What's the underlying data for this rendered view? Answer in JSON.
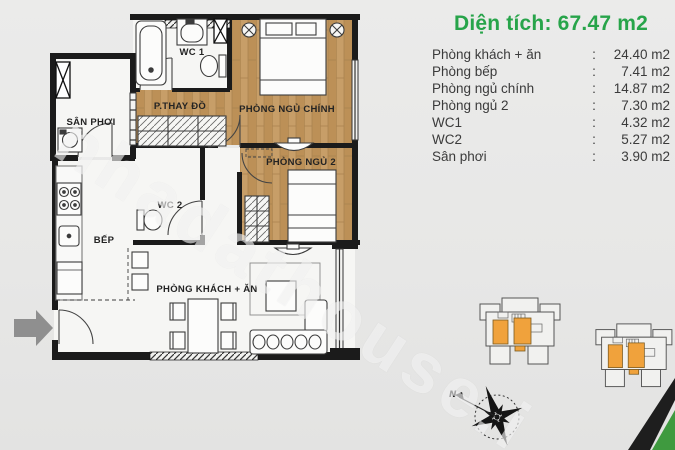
{
  "info": {
    "title": "Diện tích: 67.47 m2",
    "rows": [
      {
        "label": "Phòng khách + ăn",
        "sep": ":",
        "value": "24.40 m2"
      },
      {
        "label": "Phòng bếp",
        "sep": ":",
        "value": "7.41 m2"
      },
      {
        "label": "Phòng ngủ chính",
        "sep": ":",
        "value": "14.87 m2"
      },
      {
        "label": "Phòng ngủ 2",
        "sep": ":",
        "value": "7.30 m2"
      },
      {
        "label": "WC1",
        "sep": ":",
        "value": "4.32 m2"
      },
      {
        "label": "WC2",
        "sep": ":",
        "value": "5.27 m2"
      },
      {
        "label": "Sân phơi",
        "sep": ":",
        "value": "3.90 m2"
      }
    ]
  },
  "floorplan": {
    "labels": {
      "wc1": "WC 1",
      "dressing": "P.THAY ĐỒ",
      "master_bedroom": "PHÒNG NGỦ CHÍNH",
      "balcony": "SÂN PHƠI",
      "wc2": "WC 2",
      "bedroom2": "PHÒNG NGỦ 2",
      "kitchen": "BẾP",
      "living_dining": "PHÒNG KHÁCH + ĂN"
    }
  },
  "watermark": "nhadathouse.i",
  "compass": {
    "north_label": "N"
  },
  "colors": {
    "title_green": "#27a44a",
    "wood_floor": "#c49a66",
    "unit_highlight_orange": "#f0a23c",
    "corner_green": "#3f9a3f"
  }
}
